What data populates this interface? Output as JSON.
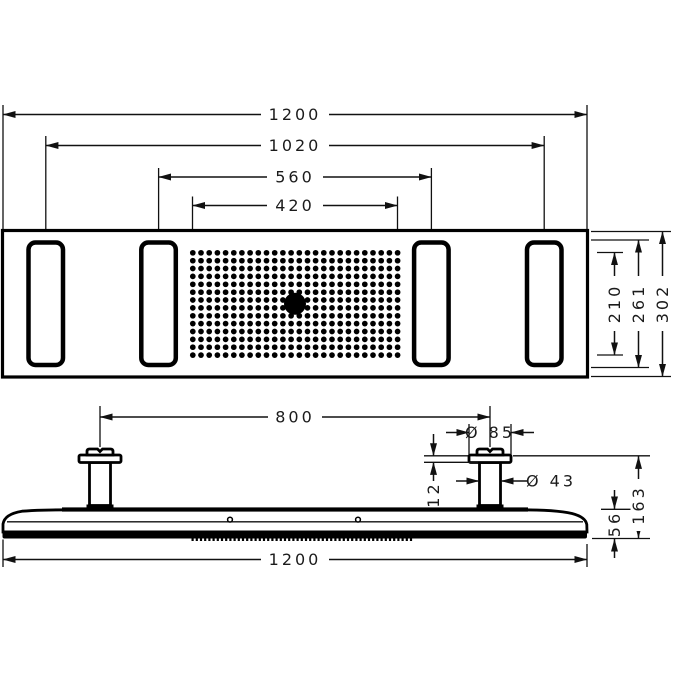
{
  "drawing": {
    "background": "#ffffff",
    "line_color": "#111111",
    "top_view": {
      "description": "overhead shower, plan view with four spray zones and central nozzle field",
      "dims": {
        "overall_width": "1200",
        "outer_zone_spacing": "1020",
        "inner_zone_spacing": "560",
        "spray_field_width": "420",
        "spray_field_depth": "210",
        "zone_depth": "261",
        "overall_depth": "302"
      }
    },
    "side_view": {
      "description": "overhead shower, side elevation with two ceiling connectors",
      "dims": {
        "connector_spacing": "800",
        "escutcheon_diameter": "Ø 85",
        "connector_diameter": "Ø 43",
        "escutcheon_height": "12",
        "body_height": "56",
        "total_height": "163",
        "overall_width": "1200"
      }
    }
  }
}
